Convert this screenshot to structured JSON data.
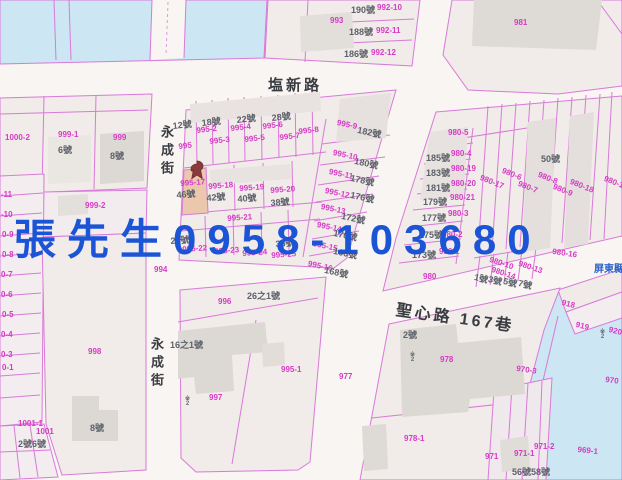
{
  "map": {
    "overlay": {
      "text": "張先生0958-103680",
      "color": "#1b55d6"
    },
    "watermark": {
      "text": "屏東縣",
      "x": 594,
      "y": 260
    },
    "colors": {
      "parcel_line": "#d87ad8",
      "parcel_number": "#d63ac6",
      "house_number": "#5c6069",
      "street_name": "#3a3d42",
      "overlay_blue": "#1b55d6",
      "water": "#cde6f3",
      "road": "#f8f5f2",
      "parcel_fill": "#f1ebe9",
      "building_fill": "#dcd8d4",
      "highlight_parcel": "#ebc7ae",
      "pin": "#8a3c3c"
    },
    "streets": [
      {
        "text": "塩新路",
        "x": 268,
        "y": 74,
        "vertical": false,
        "size": 15,
        "rot": 0
      },
      {
        "text": "永成街",
        "x": 157,
        "y": 125,
        "vertical": true,
        "size": 13,
        "rot": 0
      },
      {
        "text": "永成街",
        "x": 147,
        "y": 337,
        "vertical": true,
        "size": 13,
        "rot": 0
      },
      {
        "text": "聖心路 167巷",
        "x": 398,
        "y": 296,
        "vertical": false,
        "size": 16,
        "rot": 8
      }
    ],
    "highlighted_parcel": {
      "parcel": "995-17",
      "house": "46號"
    },
    "parcel_labels": [
      {
        "text": "993",
        "x": 330,
        "y": 16,
        "rot": 0
      },
      {
        "text": "992-10",
        "x": 377,
        "y": 3,
        "rot": 0
      },
      {
        "text": "992-11",
        "x": 376,
        "y": 26,
        "rot": 0
      },
      {
        "text": "992-12",
        "x": 371,
        "y": 48,
        "rot": 0
      },
      {
        "text": "981",
        "x": 514,
        "y": 18,
        "rot": 0
      },
      {
        "text": "1000-2",
        "x": 5,
        "y": 133,
        "rot": 0
      },
      {
        "text": "999-1",
        "x": 58,
        "y": 130,
        "rot": 0
      },
      {
        "text": "999",
        "x": 113,
        "y": 133,
        "rot": 0
      },
      {
        "text": "999-2",
        "x": 85,
        "y": 201,
        "rot": 0
      },
      {
        "text": "994",
        "x": 154,
        "y": 265,
        "rot": 0
      },
      {
        "text": "998",
        "x": 88,
        "y": 347,
        "rot": 0
      },
      {
        "text": "1001-1",
        "x": 18,
        "y": 419,
        "rot": 0
      },
      {
        "text": "1001",
        "x": 36,
        "y": 427,
        "rot": 0
      },
      {
        "text": "-11",
        "x": 1,
        "y": 190,
        "rot": 0
      },
      {
        "text": "-10",
        "x": 1,
        "y": 210,
        "rot": 0
      },
      {
        "text": "0-9",
        "x": 2,
        "y": 230,
        "rot": 0
      },
      {
        "text": "0-8",
        "x": 2,
        "y": 250,
        "rot": 0
      },
      {
        "text": "0-7",
        "x": 1,
        "y": 270,
        "rot": 0
      },
      {
        "text": "0-6",
        "x": 1,
        "y": 290,
        "rot": 0
      },
      {
        "text": "0-5",
        "x": 2,
        "y": 310,
        "rot": 0
      },
      {
        "text": "0-4",
        "x": 1,
        "y": 330,
        "rot": 0
      },
      {
        "text": "0-3",
        "x": 1,
        "y": 350,
        "rot": 0
      },
      {
        "text": "0-1",
        "x": 2,
        "y": 363,
        "rot": 0
      },
      {
        "text": "995",
        "x": 178,
        "y": 142,
        "rot": -6
      },
      {
        "text": "995-2",
        "x": 196,
        "y": 126,
        "rot": -6
      },
      {
        "text": "995-3",
        "x": 209,
        "y": 137,
        "rot": -6
      },
      {
        "text": "995-4",
        "x": 230,
        "y": 124,
        "rot": -6
      },
      {
        "text": "995-5",
        "x": 244,
        "y": 135,
        "rot": -6
      },
      {
        "text": "995-6",
        "x": 262,
        "y": 122,
        "rot": -6
      },
      {
        "text": "995-7",
        "x": 279,
        "y": 133,
        "rot": -6
      },
      {
        "text": "995-8",
        "x": 298,
        "y": 127,
        "rot": -6
      },
      {
        "text": "995-9",
        "x": 338,
        "y": 118,
        "rot": 12
      },
      {
        "text": "995-10",
        "x": 334,
        "y": 148,
        "rot": 12
      },
      {
        "text": "995-11",
        "x": 330,
        "y": 167,
        "rot": 12
      },
      {
        "text": "995-12",
        "x": 326,
        "y": 186,
        "rot": 12
      },
      {
        "text": "995-13",
        "x": 322,
        "y": 202,
        "rot": 12
      },
      {
        "text": "995-14",
        "x": 318,
        "y": 220,
        "rot": 12
      },
      {
        "text": "995-15",
        "x": 314,
        "y": 239,
        "rot": 12
      },
      {
        "text": "995-16",
        "x": 309,
        "y": 259,
        "rot": 12
      },
      {
        "text": "995-17",
        "x": 180,
        "y": 179,
        "rot": -4
      },
      {
        "text": "995-18",
        "x": 208,
        "y": 182,
        "rot": -4
      },
      {
        "text": "995-19",
        "x": 239,
        "y": 184,
        "rot": -4
      },
      {
        "text": "995-20",
        "x": 270,
        "y": 186,
        "rot": -4
      },
      {
        "text": "995-21",
        "x": 227,
        "y": 214,
        "rot": -4
      },
      {
        "text": "995-22",
        "x": 182,
        "y": 245,
        "rot": -4
      },
      {
        "text": "995-23",
        "x": 214,
        "y": 247,
        "rot": -4
      },
      {
        "text": "995-24",
        "x": 242,
        "y": 249,
        "rot": -4
      },
      {
        "text": "995-25",
        "x": 271,
        "y": 251,
        "rot": -4
      },
      {
        "text": "996",
        "x": 218,
        "y": 297,
        "rot": 0
      },
      {
        "text": "997",
        "x": 209,
        "y": 393,
        "rot": 0
      },
      {
        "text": "995-1",
        "x": 281,
        "y": 365,
        "rot": 0
      },
      {
        "text": "977",
        "x": 339,
        "y": 372,
        "rot": 0
      },
      {
        "text": "978",
        "x": 440,
        "y": 355,
        "rot": 0
      },
      {
        "text": "978-1",
        "x": 404,
        "y": 434,
        "rot": 0
      },
      {
        "text": "980-5",
        "x": 448,
        "y": 128,
        "rot": 0
      },
      {
        "text": "980-4",
        "x": 451,
        "y": 149,
        "rot": 0
      },
      {
        "text": "980-19",
        "x": 451,
        "y": 164,
        "rot": 0
      },
      {
        "text": "980-20",
        "x": 451,
        "y": 179,
        "rot": 0
      },
      {
        "text": "980-21",
        "x": 450,
        "y": 193,
        "rot": 0
      },
      {
        "text": "980-3",
        "x": 448,
        "y": 209,
        "rot": 0
      },
      {
        "text": "980-2",
        "x": 442,
        "y": 230,
        "rot": 0
      },
      {
        "text": "980-1",
        "x": 439,
        "y": 247,
        "rot": 0
      },
      {
        "text": "980",
        "x": 423,
        "y": 272,
        "rot": 0
      },
      {
        "text": "980-17",
        "x": 482,
        "y": 173,
        "rot": 22
      },
      {
        "text": "980-6",
        "x": 504,
        "y": 166,
        "rot": 22
      },
      {
        "text": "980-7",
        "x": 520,
        "y": 179,
        "rot": 22
      },
      {
        "text": "980-8",
        "x": 540,
        "y": 170,
        "rot": 22
      },
      {
        "text": "980-9",
        "x": 555,
        "y": 182,
        "rot": 22
      },
      {
        "text": "980-18",
        "x": 572,
        "y": 177,
        "rot": 22
      },
      {
        "text": "980-15",
        "x": 606,
        "y": 174,
        "rot": 22
      },
      {
        "text": "980-16",
        "x": 553,
        "y": 247,
        "rot": 8
      },
      {
        "text": "980-10",
        "x": 491,
        "y": 255,
        "rot": 18
      },
      {
        "text": "980-13",
        "x": 520,
        "y": 259,
        "rot": 18
      },
      {
        "text": "980-14",
        "x": 493,
        "y": 265,
        "rot": 18
      },
      {
        "text": "918",
        "x": 563,
        "y": 298,
        "rot": 14
      },
      {
        "text": "919",
        "x": 577,
        "y": 320,
        "rot": 14
      },
      {
        "text": "920",
        "x": 610,
        "y": 325,
        "rot": 14
      },
      {
        "text": "970-3",
        "x": 517,
        "y": 364,
        "rot": 8
      },
      {
        "text": "970",
        "x": 606,
        "y": 375,
        "rot": 8
      },
      {
        "text": "971",
        "x": 485,
        "y": 452,
        "rot": 0
      },
      {
        "text": "971-1",
        "x": 514,
        "y": 449,
        "rot": 0
      },
      {
        "text": "971-2",
        "x": 534,
        "y": 442,
        "rot": 0
      },
      {
        "text": "969-1",
        "x": 578,
        "y": 445,
        "rot": 6
      }
    ],
    "house_labels": [
      {
        "text": "190號",
        "x": 351,
        "y": 3,
        "rot": 0
      },
      {
        "text": "188號",
        "x": 349,
        "y": 25,
        "rot": 0
      },
      {
        "text": "186號",
        "x": 344,
        "y": 47,
        "rot": 0
      },
      {
        "text": "6號",
        "x": 58,
        "y": 143,
        "rot": 0
      },
      {
        "text": "8號",
        "x": 110,
        "y": 149,
        "rot": 0
      },
      {
        "text": "8號",
        "x": 90,
        "y": 421,
        "rot": 0
      },
      {
        "text": "2號6號",
        "x": 18,
        "y": 437,
        "rot": 0
      },
      {
        "text": "12號",
        "x": 172,
        "y": 119,
        "rot": -6
      },
      {
        "text": "18號",
        "x": 201,
        "y": 116,
        "rot": -6
      },
      {
        "text": "22號",
        "x": 236,
        "y": 113,
        "rot": -6
      },
      {
        "text": "28號",
        "x": 271,
        "y": 111,
        "rot": -6
      },
      {
        "text": "182號",
        "x": 359,
        "y": 123,
        "rot": 12
      },
      {
        "text": "180號",
        "x": 356,
        "y": 154,
        "rot": 12
      },
      {
        "text": "178號",
        "x": 352,
        "y": 171,
        "rot": 12
      },
      {
        "text": "176號",
        "x": 352,
        "y": 188,
        "rot": 12
      },
      {
        "text": "172號",
        "x": 343,
        "y": 209,
        "rot": 12
      },
      {
        "text": "170號",
        "x": 335,
        "y": 226,
        "rot": 12
      },
      {
        "text": "166號",
        "x": 335,
        "y": 244,
        "rot": 12
      },
      {
        "text": "168號",
        "x": 326,
        "y": 263,
        "rot": 12
      },
      {
        "text": "46號",
        "x": 176,
        "y": 188,
        "rot": -4
      },
      {
        "text": "42號",
        "x": 206,
        "y": 191,
        "rot": -4
      },
      {
        "text": "40號",
        "x": 237,
        "y": 192,
        "rot": -4
      },
      {
        "text": "38號",
        "x": 270,
        "y": 196,
        "rot": -4
      },
      {
        "text": "28號",
        "x": 170,
        "y": 234,
        "rot": -4
      },
      {
        "text": "36號",
        "x": 275,
        "y": 237,
        "rot": -4
      },
      {
        "text": "26之1號",
        "x": 247,
        "y": 289,
        "rot": 0
      },
      {
        "text": "16之1號",
        "x": 170,
        "y": 338,
        "rot": 0
      },
      {
        "text": "185號",
        "x": 426,
        "y": 151,
        "rot": 0
      },
      {
        "text": "183號",
        "x": 426,
        "y": 166,
        "rot": 0
      },
      {
        "text": "181號",
        "x": 426,
        "y": 181,
        "rot": 0
      },
      {
        "text": "179號",
        "x": 423,
        "y": 195,
        "rot": 0
      },
      {
        "text": "177號",
        "x": 422,
        "y": 211,
        "rot": 0
      },
      {
        "text": "175號",
        "x": 419,
        "y": 228,
        "rot": 0
      },
      {
        "text": "173號",
        "x": 412,
        "y": 248,
        "rot": 0
      },
      {
        "text": "50號",
        "x": 541,
        "y": 152,
        "rot": 0
      },
      {
        "text": "1號",
        "x": 476,
        "y": 270,
        "rot": 14
      },
      {
        "text": "3號",
        "x": 490,
        "y": 272,
        "rot": 14
      },
      {
        "text": "5號",
        "x": 505,
        "y": 274,
        "rot": 14
      },
      {
        "text": "7號",
        "x": 520,
        "y": 276,
        "rot": 14
      },
      {
        "text": "2號",
        "x": 403,
        "y": 328,
        "rot": 0
      },
      {
        "text": "56號58號",
        "x": 512,
        "y": 465,
        "rot": 0
      }
    ],
    "symbol_marks": [
      {
        "text": "※\n2",
        "x": 185,
        "y": 397
      },
      {
        "text": "※\n2",
        "x": 410,
        "y": 353
      },
      {
        "text": "※\n2",
        "x": 600,
        "y": 330
      }
    ]
  }
}
